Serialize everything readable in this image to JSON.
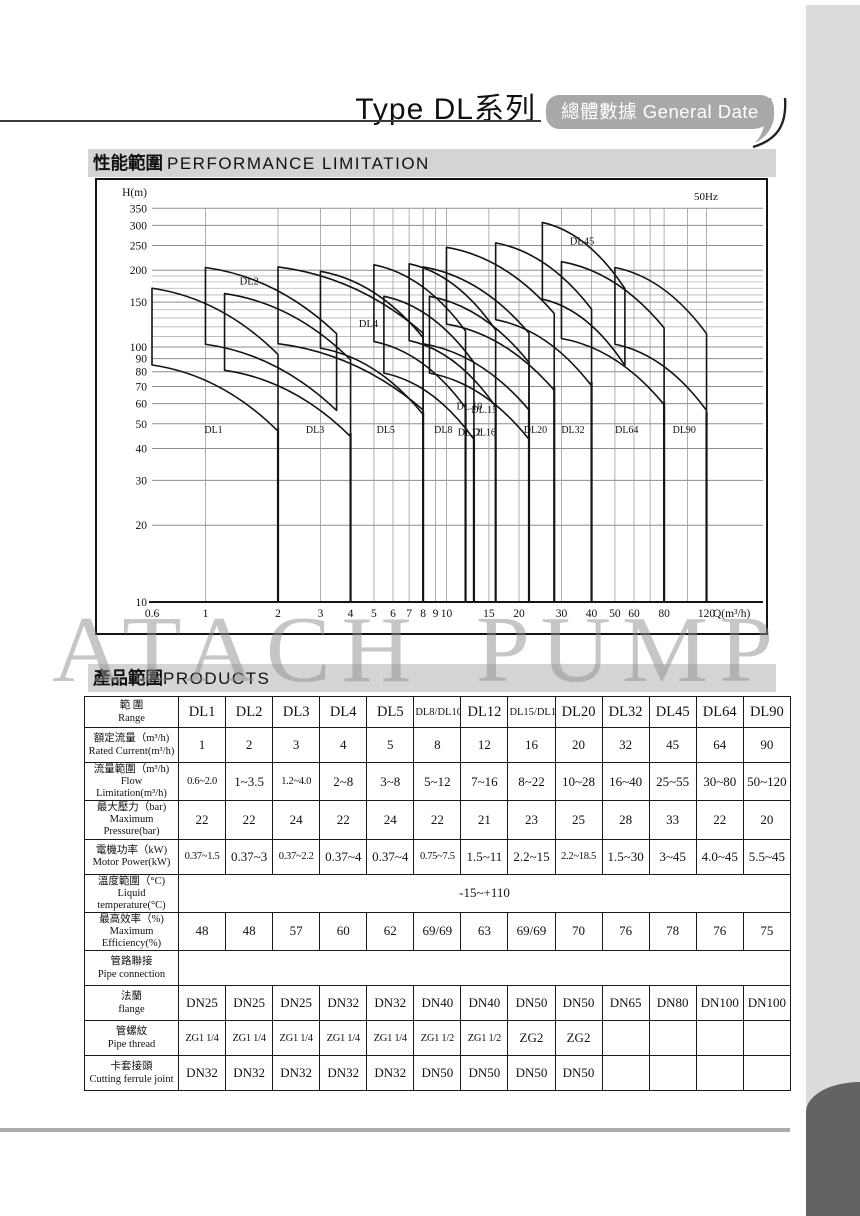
{
  "page": {
    "title": "Type DL系列",
    "tab_label": "總體數據 General Date",
    "watermark": "ATACH PUMP",
    "section_performance_zh": "性能範圍",
    "section_performance_en": "PERFORMANCE  LIMITATION",
    "section_products_zh": "產品範圍",
    "section_products_en": "PRODUCTS",
    "accent_gray": "#a8a8a8",
    "bar_gray": "#d4d4d4",
    "dark_corner_gray": "#636363"
  },
  "chart_data": {
    "type": "area",
    "title": "Pump performance limitation envelopes",
    "frequency_label": "50Hz",
    "y_axis_label": "H(m)",
    "x_axis_label": "Q(m³/h)",
    "x_scale": "log",
    "y_scale": "log",
    "xlim": [
      0.6,
      140
    ],
    "ylim": [
      10,
      380
    ],
    "y_ticks": [
      350,
      300,
      250,
      200,
      150,
      100,
      90,
      80,
      70,
      60,
      50,
      40,
      30,
      20,
      10
    ],
    "x_ticks": [
      0.6,
      1,
      2,
      3,
      4,
      5,
      6,
      7,
      8,
      9,
      10,
      15,
      20,
      30,
      40,
      50,
      60,
      80,
      120
    ],
    "x_grid": [
      1,
      2,
      3,
      4,
      5,
      6,
      7,
      8,
      9,
      10,
      15,
      20,
      30,
      40,
      50,
      60,
      70,
      80,
      100,
      120
    ],
    "y_grid_major": [
      20,
      30,
      40,
      50,
      60,
      70,
      80,
      90,
      100,
      150,
      200,
      250,
      300,
      350
    ],
    "y_grid_minor": [
      110,
      120,
      130,
      140,
      160,
      170,
      180,
      190
    ],
    "pumps": [
      {
        "name": "DL1",
        "q_min": 0.6,
        "q_max": 2.0,
        "h_peak": 170
      },
      {
        "name": "DL2",
        "q_min": 1.0,
        "q_max": 3.5,
        "h_peak": 205
      },
      {
        "name": "DL3",
        "q_min": 1.2,
        "q_max": 4.0,
        "h_peak": 162
      },
      {
        "name": "DL4",
        "q_min": 2.0,
        "q_max": 8.0,
        "h_peak": 206
      },
      {
        "name": "DL5",
        "q_min": 3.0,
        "q_max": 8.0,
        "h_peak": 198
      },
      {
        "name": "DL8",
        "q_min": 5.0,
        "q_max": 12.0,
        "h_peak": 210
      },
      {
        "name": "DL10",
        "q_min": 5.5,
        "q_max": 13.0,
        "h_peak": 158
      },
      {
        "name": "DL12",
        "q_min": 7.0,
        "q_max": 16.0,
        "h_peak": 212
      },
      {
        "name": "DL15",
        "q_min": 8.0,
        "q_max": 22.0,
        "h_peak": 206
      },
      {
        "name": "DL16",
        "q_min": 8.5,
        "q_max": 22.0,
        "h_peak": 158
      },
      {
        "name": "DL20",
        "q_min": 10.0,
        "q_max": 28.0,
        "h_peak": 246
      },
      {
        "name": "DL32",
        "q_min": 16.0,
        "q_max": 40.0,
        "h_peak": 256
      },
      {
        "name": "DL45",
        "q_min": 25.0,
        "q_max": 55.0,
        "h_peak": 308
      },
      {
        "name": "DL64",
        "q_min": 30.0,
        "q_max": 80.0,
        "h_peak": 216
      },
      {
        "name": "DL90",
        "q_min": 50.0,
        "q_max": 120.0,
        "h_peak": 205
      }
    ],
    "separators": [
      {
        "q": 2,
        "h_top": 48
      },
      {
        "q": 4,
        "h_top": 46
      },
      {
        "q": 8,
        "h_top": 56
      },
      {
        "q": 12,
        "h_top": 60
      },
      {
        "q": 13,
        "h_top": 45
      },
      {
        "q": 16,
        "h_top": 60
      },
      {
        "q": 22,
        "h_top": 58
      },
      {
        "q": 28,
        "h_top": 70
      },
      {
        "q": 40,
        "h_top": 73
      },
      {
        "q": 80,
        "h_top": 61
      },
      {
        "q": 120,
        "h_top": 56
      }
    ],
    "region_labels": [
      {
        "text": "DL1",
        "q": 1.08,
        "h": 46
      },
      {
        "text": "DL3",
        "q": 2.85,
        "h": 46
      },
      {
        "text": "DL5",
        "q": 5.6,
        "h": 46
      },
      {
        "text": "DL8",
        "q": 9.7,
        "h": 46
      },
      {
        "text": "DL.10",
        "q": 12.45,
        "h": 57
      },
      {
        "text": "DL12",
        "q": 12.45,
        "h": 45
      },
      {
        "text": "DL.15",
        "q": 14.35,
        "h": 55
      },
      {
        "text": "DL16",
        "q": 14.35,
        "h": 45
      },
      {
        "text": "DL20",
        "q": 23.4,
        "h": 46
      },
      {
        "text": "DL32",
        "q": 33.5,
        "h": 46
      },
      {
        "text": "DL64",
        "q": 56.0,
        "h": 46
      },
      {
        "text": "DL90",
        "q": 97.0,
        "h": 46
      }
    ],
    "curve_labels": [
      {
        "text": "DL2",
        "q": 1.52,
        "h": 176
      },
      {
        "text": "DL4",
        "q": 4.75,
        "h": 120
      },
      {
        "text": "DL45",
        "q": 36.5,
        "h": 252
      }
    ]
  },
  "table": {
    "header": {
      "range_zh": "範 圍",
      "range_en": "Range",
      "columns": [
        "DL1",
        "DL2",
        "DL3",
        "DL4",
        "DL5",
        "DL8/DL10",
        "DL12",
        "DL15/DL16",
        "DL20",
        "DL32",
        "DL45",
        "DL64",
        "DL90"
      ]
    },
    "rows": [
      {
        "label_zh": "額定流量（m³/h)",
        "label_en": "Rated Current(m³/h)",
        "cells": [
          "1",
          "2",
          "3",
          "4",
          "5",
          "8",
          "12",
          "16",
          "20",
          "32",
          "45",
          "64",
          "90"
        ]
      },
      {
        "label_zh": "流量範圍（m³/h)",
        "label_en": "Flow Limitation(m³/h)",
        "cells": [
          "0.6~2.0",
          "1~3.5",
          "1.2~4.0",
          "2~8",
          "3~8",
          "5~12",
          "7~16",
          "8~22",
          "10~28",
          "16~40",
          "25~55",
          "30~80",
          "50~120"
        ]
      },
      {
        "label_zh": "最大壓力（bar)",
        "label_en": "Maximum Pressure(bar)",
        "cells": [
          "22",
          "22",
          "24",
          "22",
          "24",
          "22",
          "21",
          "23",
          "25",
          "28",
          "33",
          "22",
          "20"
        ]
      },
      {
        "label_zh": "電機功率（kW)",
        "label_en": "Motor Power(kW)",
        "cells": [
          "0.37~1.5",
          "0.37~3",
          "0.37~2.2",
          "0.37~4",
          "0.37~4",
          "0.75~7.5",
          "1.5~11",
          "2.2~15",
          "2.2~18.5",
          "1.5~30",
          "3~45",
          "4.0~45",
          "5.5~45"
        ]
      },
      {
        "label_zh": "溫度範圍（°C)",
        "label_en": "Liquid temperature(°C)",
        "span_value": "-15~+110"
      },
      {
        "label_zh": "最高效率（%)",
        "label_en": "Maximum Efficiency(%)",
        "cells": [
          "48",
          "48",
          "57",
          "60",
          "62",
          "69/69",
          "63",
          "69/69",
          "70",
          "76",
          "78",
          "76",
          "75"
        ]
      },
      {
        "label_zh": "管路聯接",
        "label_en": "Pipe connection",
        "span_value": ""
      },
      {
        "label_zh": "法蘭",
        "label_en": "flange",
        "cells": [
          "DN25",
          "DN25",
          "DN25",
          "DN32",
          "DN32",
          "DN40",
          "DN40",
          "DN50",
          "DN50",
          "DN65",
          "DN80",
          "DN100",
          "DN100"
        ]
      },
      {
        "label_zh": "管螺紋",
        "label_en": "Pipe thread",
        "cells": [
          "ZG1 1/4",
          "ZG1 1/4",
          "ZG1 1/4",
          "ZG1 1/4",
          "ZG1 1/4",
          "ZG1 1/2",
          "ZG1 1/2",
          "ZG2",
          "ZG2",
          "",
          "",
          "",
          ""
        ]
      },
      {
        "label_zh": "卡套接頭",
        "label_en": "Cutting ferrule joint",
        "cells": [
          "DN32",
          "DN32",
          "DN32",
          "DN32",
          "DN32",
          "DN50",
          "DN50",
          "DN50",
          "DN50",
          "",
          "",
          "",
          ""
        ]
      }
    ]
  }
}
